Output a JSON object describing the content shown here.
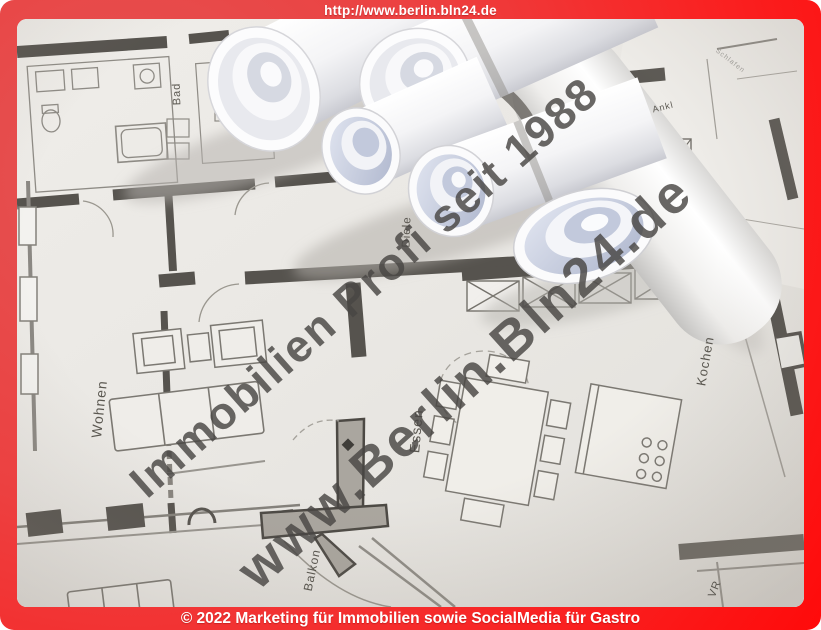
{
  "frame": {
    "top_url": "http://www.berlin.bln24.de",
    "bottom_copyright": "© 2022 Marketing für Immobilien sowie SocialMedia für Gastro"
  },
  "watermark": {
    "line1": "Immobilien Profi seit 1988",
    "line2": "www.Berlin.Bln24.de"
  },
  "floorplan": {
    "labels": {
      "bad": "Bad",
      "wohnen": "Wohnen",
      "diele": "Diele",
      "essen": "Essen",
      "kochen": "Kochen",
      "balkon": "Balkon",
      "ankl": "Ankl",
      "vr": "VR",
      "schlafen": "Schlafen"
    }
  },
  "colors": {
    "frame_red_bright": "#ff0a0a",
    "frame_red_soft": "#e25454",
    "bar_text": "#ffffff",
    "watermark_gray": "#484643",
    "paper": "#eceae6",
    "wall_dark": "#56534e",
    "roll_interior_blue": "#c2c9dc"
  }
}
